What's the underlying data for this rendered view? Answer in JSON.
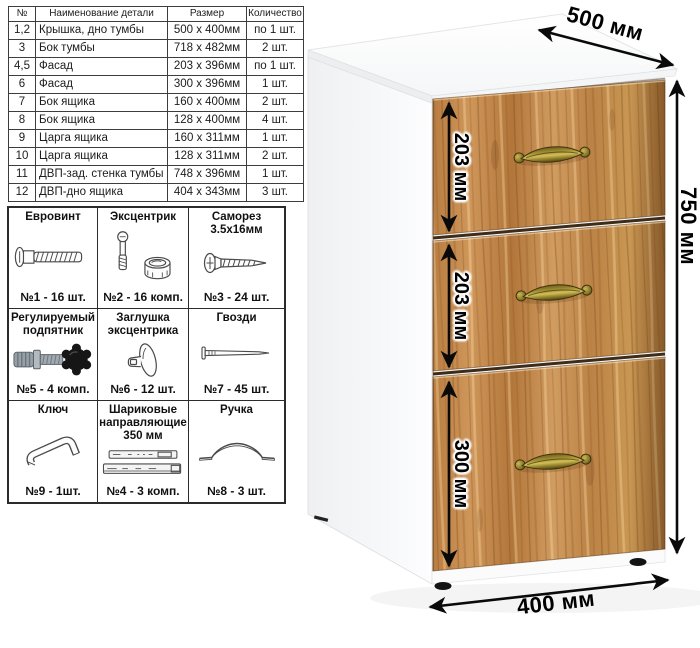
{
  "parts_table": {
    "headers": [
      "№",
      "Наименование детали",
      "Размер",
      "Количество"
    ],
    "rows": [
      [
        "1,2",
        "Крышка, дно тумбы",
        "500 х 400мм",
        "по 1 шт."
      ],
      [
        "3",
        "Бок тумбы",
        "718 х 482мм",
        "2 шт."
      ],
      [
        "4,5",
        "Фасад",
        "203 х 396мм",
        "по 1 шт."
      ],
      [
        "6",
        "Фасад",
        "300 х 396мм",
        "1 шт."
      ],
      [
        "7",
        "Бок ящика",
        "160 х 400мм",
        "2 шт."
      ],
      [
        "8",
        "Бок ящика",
        "128 х 400мм",
        "4 шт."
      ],
      [
        "9",
        "Царга ящика",
        "160 х 311мм",
        "1 шт."
      ],
      [
        "10",
        "Царга ящика",
        "128 х 311мм",
        "2 шт."
      ],
      [
        "11",
        "ДВП-зад. стенка тумбы",
        "748 х 396мм",
        "1 шт."
      ],
      [
        "12",
        "ДВП-дно ящика",
        "404 х 343мм",
        "3 шт."
      ]
    ]
  },
  "hardware": {
    "items": [
      {
        "title": "Евровинт",
        "count": "№1 - 16 шт.",
        "icon": "euro-screw-icon"
      },
      {
        "title": "Эксцентрик",
        "count": "№2 - 16 комп.",
        "icon": "cam-lock-icon"
      },
      {
        "title": "Саморез 3.5х16мм",
        "count": "№3 - 24 шт.",
        "icon": "self-tapping-screw-icon"
      },
      {
        "title": "Регулируемый подпятник",
        "count": "№5 - 4 комп.",
        "icon": "adjustable-foot-icon"
      },
      {
        "title": "Заглушка эксцентрика",
        "count": "№6 - 12 шт.",
        "icon": "cam-cap-icon"
      },
      {
        "title": "Гвозди",
        "count": "№7 - 45 шт.",
        "icon": "nail-icon"
      },
      {
        "title": "Ключ",
        "count": "№9 - 1шт.",
        "icon": "hex-key-icon"
      },
      {
        "title": "Шариковые направляющие 350 мм",
        "count": "№4 - 3 комп.",
        "icon": "ball-bearing-slides-icon"
      },
      {
        "title": "Ручка",
        "count": "№8 - 3 шт.",
        "icon": "drawer-handle-icon"
      }
    ]
  },
  "diagram": {
    "dimensions": {
      "depth": "500 мм",
      "height": "750 мм",
      "width": "400 мм",
      "drawer_top": "203 мм",
      "drawer_middle": "203 мм",
      "drawer_bottom": "300 мм"
    },
    "colors": {
      "wood_base": "#bd8348",
      "wood_dark": "#9a6430",
      "wood_light": "#d8a262",
      "handle_brass": "#9c8a34",
      "carcass_white": "#ffffff",
      "dimension_text": "#000000"
    }
  }
}
